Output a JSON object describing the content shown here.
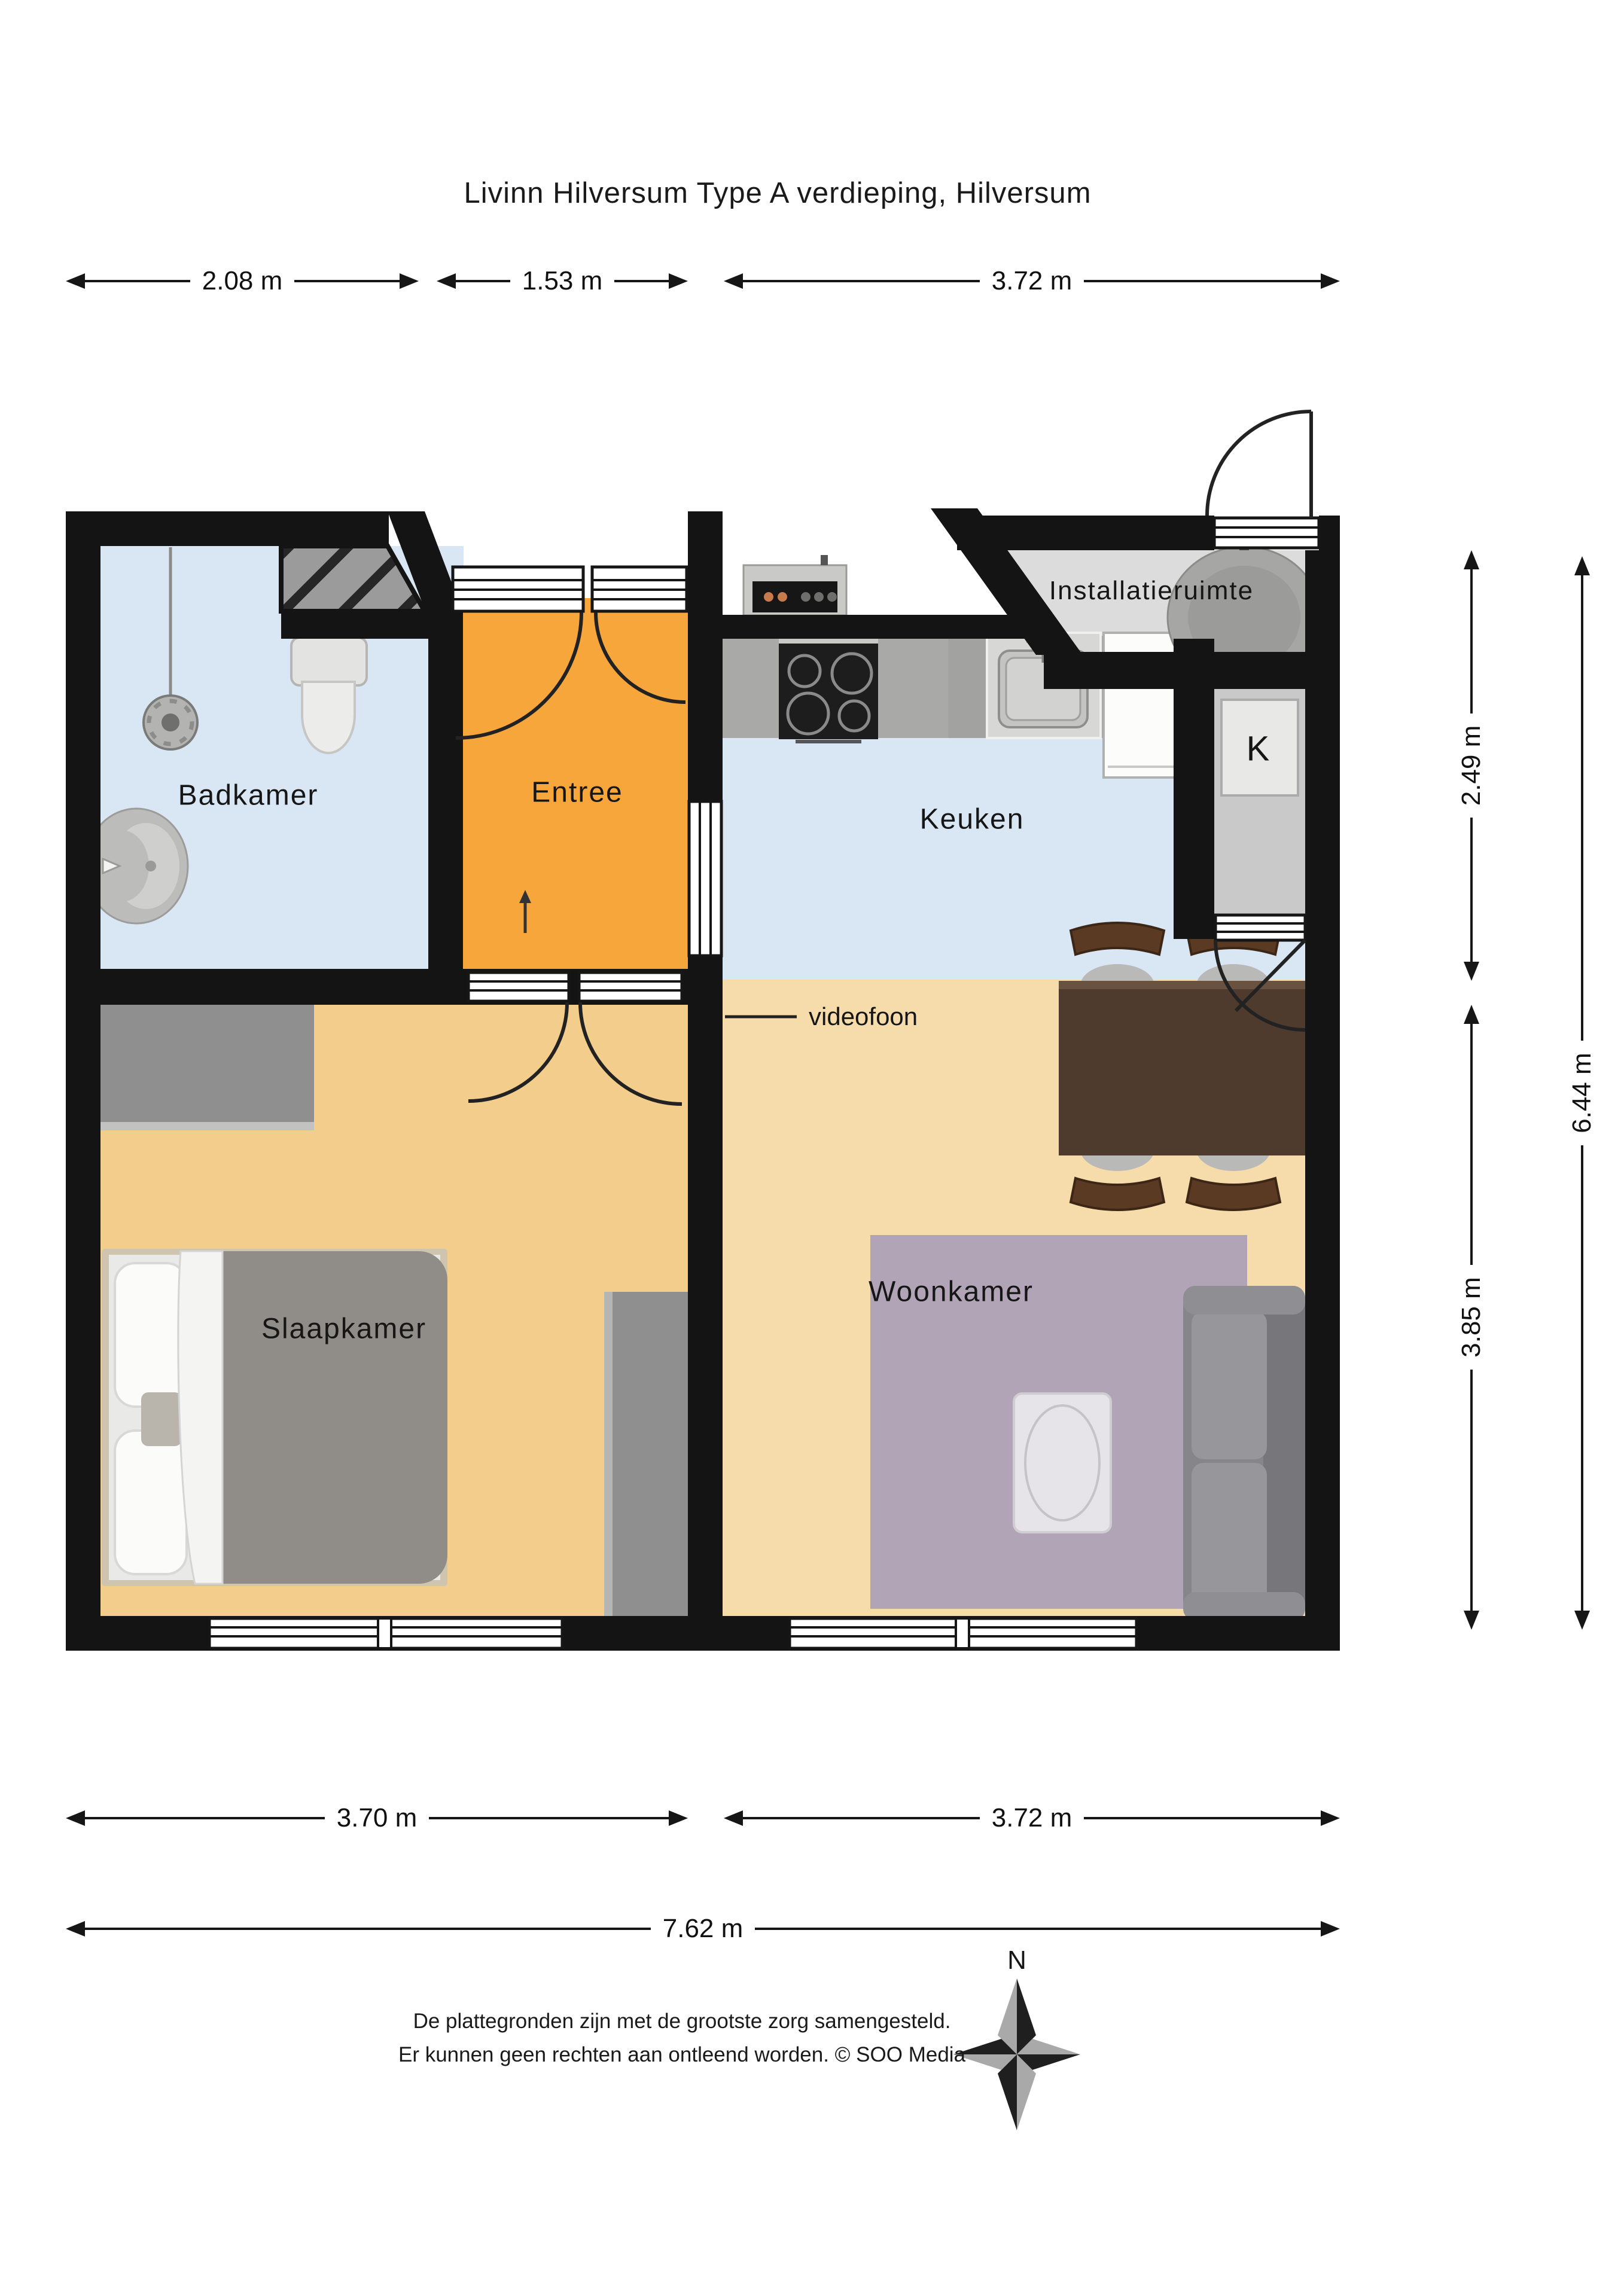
{
  "title": "Livinn Hilversum Type A verdieping, Hilversum",
  "rooms": {
    "badkamer": "Badkamer",
    "entree": "Entree",
    "keuken": "Keuken",
    "installatieruimte": "Installatieruimte",
    "kast": "K",
    "slaapkamer": "Slaapkamer",
    "woonkamer": "Woonkamer"
  },
  "annotations": {
    "videofoon": "videofoon",
    "door_swing_arrow": "↑"
  },
  "dimensions": {
    "top": [
      {
        "label": "2.08 m"
      },
      {
        "label": "1.53 m"
      },
      {
        "label": "3.72 m"
      }
    ],
    "right_inner": [
      {
        "label": "2.49 m"
      },
      {
        "label": "3.85 m"
      }
    ],
    "right_outer": {
      "label": "6.44 m"
    },
    "bottom": [
      {
        "label": "3.70 m"
      },
      {
        "label": "3.72 m"
      }
    ],
    "bottom_total": {
      "label": "7.62 m"
    },
    "unit": "m"
  },
  "compass": {
    "north": "N"
  },
  "footer": {
    "line1": "De plattegronden zijn met de grootste zorg samengesteld.",
    "line2": "Er kunnen geen rechten aan ontleend worden. © SOO Media"
  },
  "colors": {
    "wall": "#141414",
    "bathroom_floor": "#d9e6f4",
    "kitchen_floor": "#d9e6f4",
    "entree_floor": "#f6a63a",
    "bedroom_floor": "#f2cd8c",
    "livingroom_floor": "#f6dcab",
    "rug": "#b1a4b6",
    "utility_floor": "#dcdcdc",
    "closet_floor": "#c9c9c9",
    "counter": "#a9a9a7",
    "furniture_gray": "#8f8f8f",
    "table_brown": "#4e3b2d",
    "chair_brown": "#5a3a22"
  }
}
